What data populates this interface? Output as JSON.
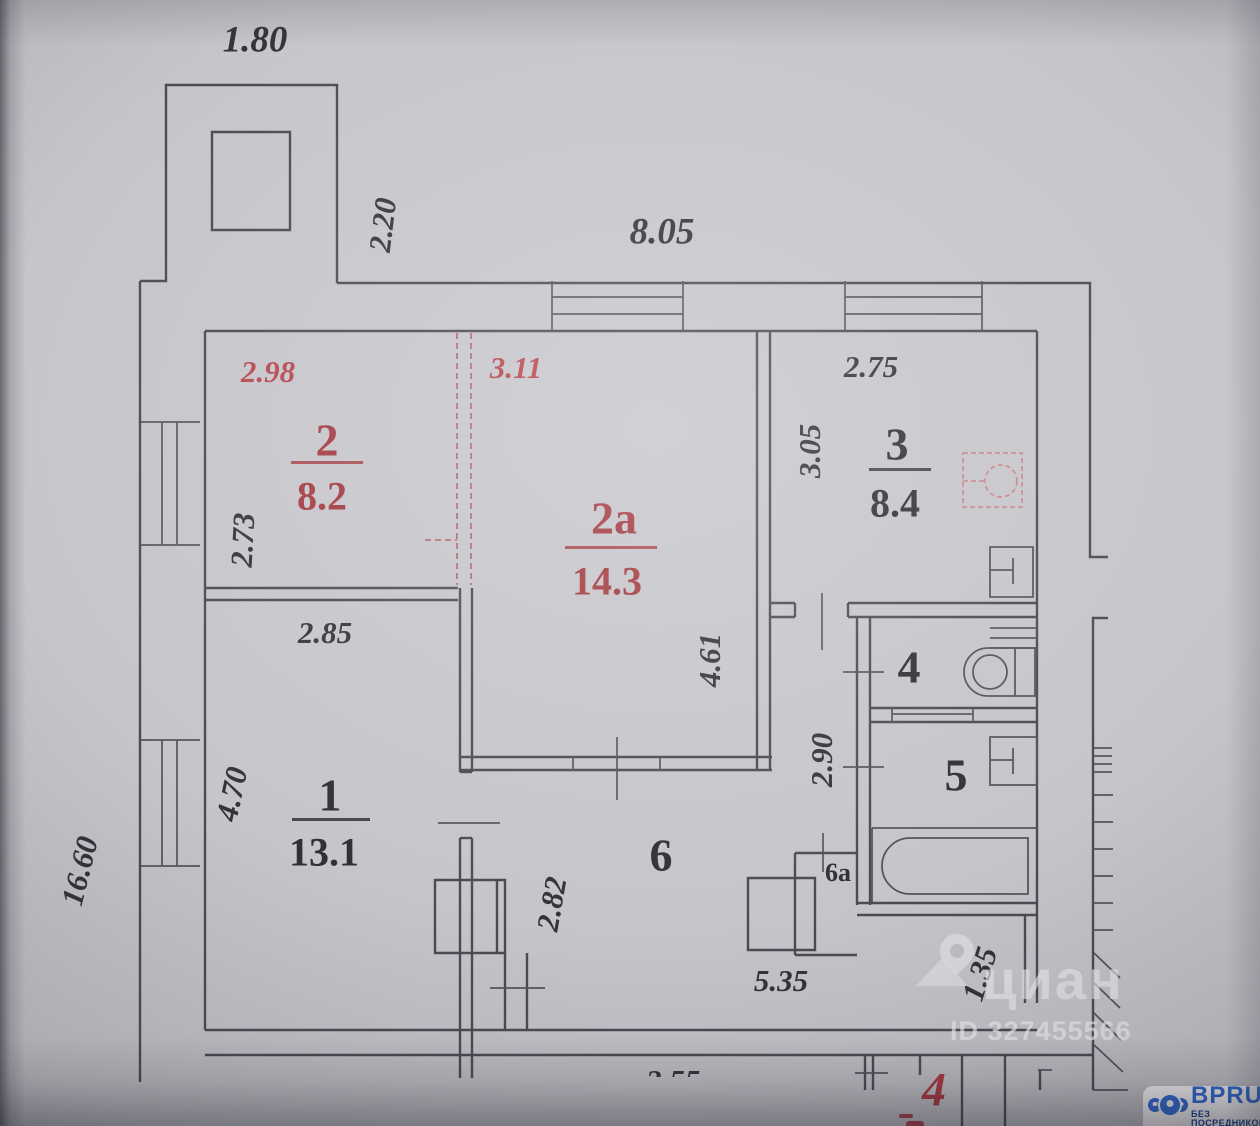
{
  "document": {
    "type": "apartment floor plan (BTI scan)"
  },
  "plan": {
    "dimensions": {
      "top_extension_width": "1.80",
      "top_extension_depth": "2.20",
      "top_width": "8.05",
      "room2_width": "2.98",
      "room2a_width": "3.11",
      "room3_width": "2.75",
      "room3_depth": "3.05",
      "room2_depth": "2.73",
      "room1_width": "2.85",
      "room2a_depth": "4.61",
      "wc_block_depth": "2.90",
      "room1_depth": "4.70",
      "left_total_height": "16.60",
      "hall_width": "2.82",
      "hall_length": "5.35",
      "entry_depth": "1.35",
      "bottom_partial": "2.55"
    },
    "rooms": {
      "room1": {
        "number": "1",
        "area": "13.1"
      },
      "room2": {
        "number": "2",
        "area": "8.2"
      },
      "room2a": {
        "number": "2a",
        "area": "14.3"
      },
      "room3": {
        "number": "3",
        "area": "8.4"
      },
      "room4": {
        "number": "4"
      },
      "room5": {
        "number": "5"
      },
      "room6": {
        "number": "6"
      },
      "room6a": {
        "number": "6a"
      }
    },
    "apartment_number": "4"
  },
  "watermark": {
    "brand": "циан",
    "listing_id": "ID 327455566"
  },
  "badge": {
    "brand": "BPRU",
    "tagline": "БЕЗ ПОСРЕДНИКОВ"
  },
  "colors": {
    "paper": "#c6c5ca",
    "ink": "#33333a",
    "red_room_label": "#a23a40",
    "red_dimension": "#b4474e",
    "red_dashed_partition": "#b5696d",
    "stove_symbol": "#c9888c",
    "badge_blue": "#2e6cd9",
    "badge_dark_blue": "#123c8c"
  }
}
